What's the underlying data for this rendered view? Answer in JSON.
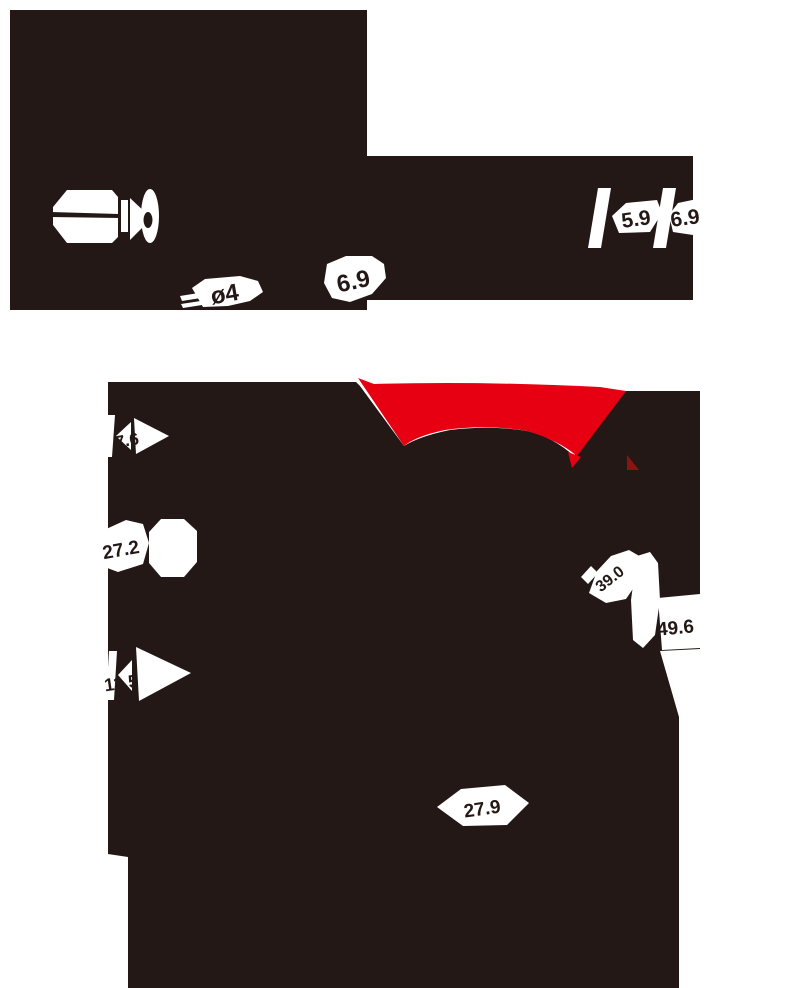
{
  "colors": {
    "silhouette": "#231815",
    "accent_red": "#e60012",
    "accent_red_dark": "#8c1410",
    "cutout": "#ffffff",
    "label_ink": "#231815",
    "background": "#ffffff"
  },
  "top_view": {
    "dim_5_9": "5.9",
    "dim_6_9_right": "6.9",
    "dim_phi4": "ø4",
    "dim_6_9_bottom": "6.9"
  },
  "front_view": {
    "dim_7_6": "7.6",
    "dim_27_2": "27.2",
    "dim_11_5": "11.5",
    "dim_39_0": "39.0",
    "dim_49_6": "49.6",
    "dim_27_9": "27.9"
  }
}
